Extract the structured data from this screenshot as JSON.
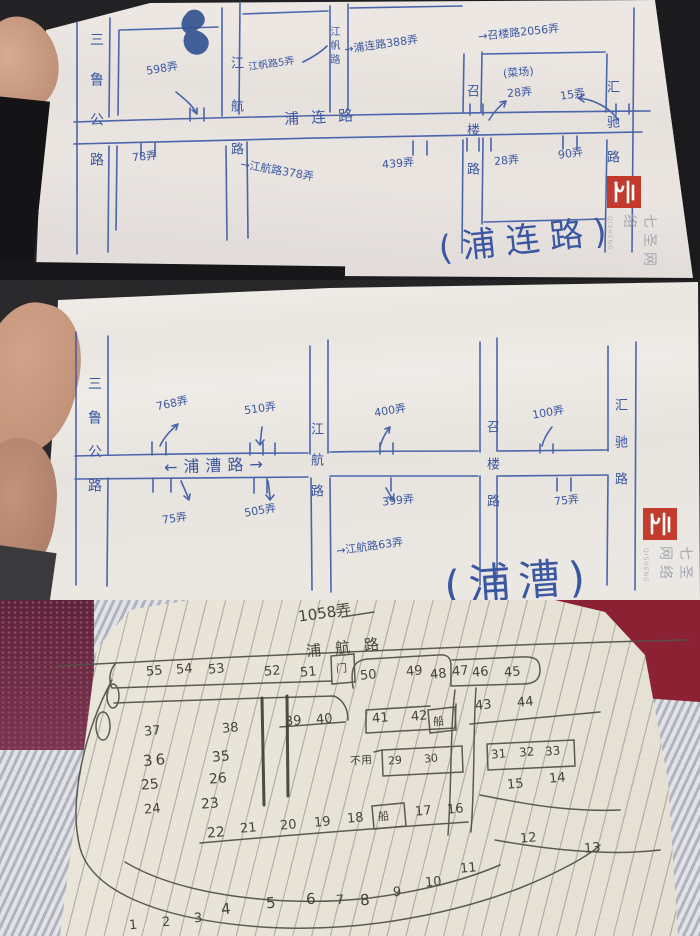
{
  "watermark": {
    "cn": "七圣网络",
    "en": "QISHENG"
  },
  "map1": {
    "roads": {
      "sanlu": "三鲁公路",
      "jianghang": "江航路",
      "jiangfan": "江帆路",
      "zhaolou": "召楼路",
      "huichi": "汇驰路",
      "pulian": "浦连路"
    },
    "notes": [
      "598弄",
      "江帆路5弄",
      "→浦连路388弄",
      "→召楼路2056弄",
      "(菜场)",
      "28弄",
      "15弄",
      "78弄",
      "→江航路378弄",
      "439弄",
      "28弄",
      "90弄"
    ],
    "big_note": "(浦连路)"
  },
  "map2": {
    "roads": {
      "sanlu": "三鲁公路",
      "jianghang": "江航路",
      "zhaolou": "召楼路",
      "huichi": "汇驰路",
      "pucao": "←浦漕路→"
    },
    "notes": [
      "768弄",
      "510弄",
      "400弄",
      "100弄",
      "75弄",
      "505弄",
      "399弄",
      "75弄",
      "→江航路63弄"
    ],
    "big_note": "(浦漕)"
  },
  "nb": {
    "title": "1058弄",
    "road": "浦航路",
    "row_top": [
      "55",
      "54",
      "53",
      "52",
      "51",
      "50",
      "49",
      "48",
      "47",
      "46",
      "45"
    ],
    "boxed_gate": "门",
    "row2": [
      "39",
      "40",
      "41",
      "42",
      "43",
      "44"
    ],
    "boxed_boat1": "船",
    "col_left": [
      "37",
      "38",
      "36",
      "35",
      "25",
      "26",
      "24",
      "23"
    ],
    "unused_label": "不用",
    "unused_numbers": [
      "29",
      "30"
    ],
    "row3": [
      "31",
      "32",
      "33",
      "15",
      "14"
    ],
    "row_bottom": [
      "22",
      "21",
      "20",
      "19",
      "18",
      "17",
      "16"
    ],
    "boxed_boat2": "船",
    "pair_right": [
      "12",
      "13"
    ],
    "curve_row": [
      "1",
      "2",
      "3",
      "4",
      "5",
      "6",
      "7",
      "8",
      "9",
      "10",
      "11"
    ]
  }
}
